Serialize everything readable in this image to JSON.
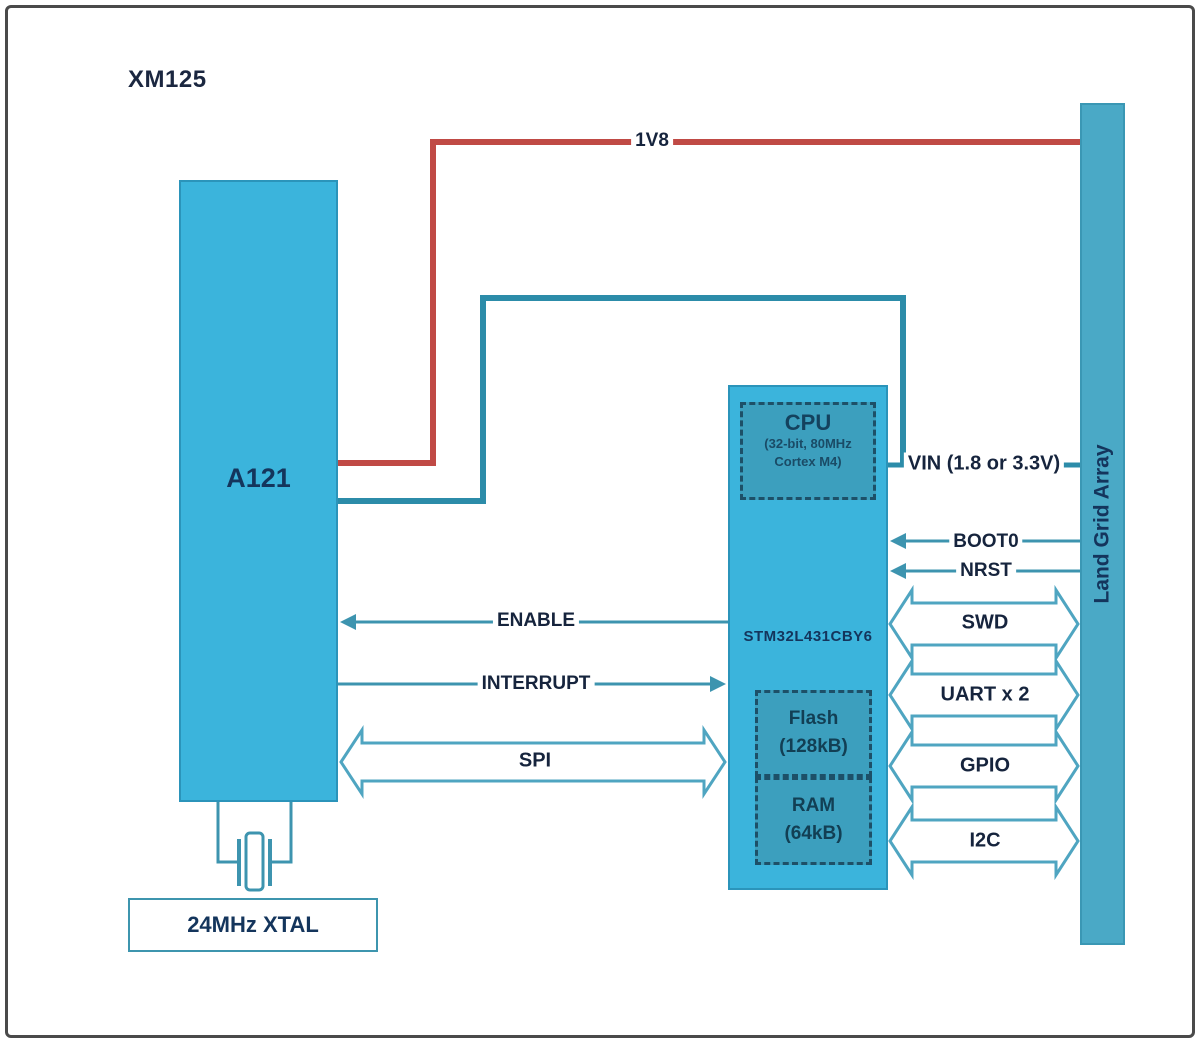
{
  "title": "XM125",
  "blocks": {
    "a121": {
      "label": "A121"
    },
    "mcu": {
      "label": "STM32L431CBY6",
      "cpu": {
        "title": "CPU",
        "subtitle_line1": "(32-bit, 80MHz",
        "subtitle_line2": "Cortex M4)"
      },
      "flash": {
        "line1": "Flash",
        "line2": "(128kB)"
      },
      "ram": {
        "line1": "RAM",
        "line2": "(64kB)"
      }
    },
    "lga": {
      "label": "Land Grid Array"
    },
    "xtal": {
      "label": "24MHz XTAL",
      "icon": "crystal-symbol"
    }
  },
  "signals": {
    "power": "1V8",
    "vin": "VIN (1.8 or 3.3V)",
    "boot0": "BOOT0",
    "nrst": "NRST",
    "swd": "SWD",
    "uart": "UART x 2",
    "gpio": "GPIO",
    "i2c": "I2C",
    "enable": "ENABLE",
    "interrupt": "INTERRUPT",
    "spi": "SPI"
  },
  "colors": {
    "block_fill": "#3bb4dc",
    "inner_block_fill": "#3c9fbe",
    "lga_fill": "#4aa9c6",
    "wire_teal": "#2c8ca9",
    "wire_red": "#c04a45",
    "arrow_outline": "#4fa5c1",
    "text_navy": "#14355c",
    "frame_border": "#4a4a4a"
  }
}
